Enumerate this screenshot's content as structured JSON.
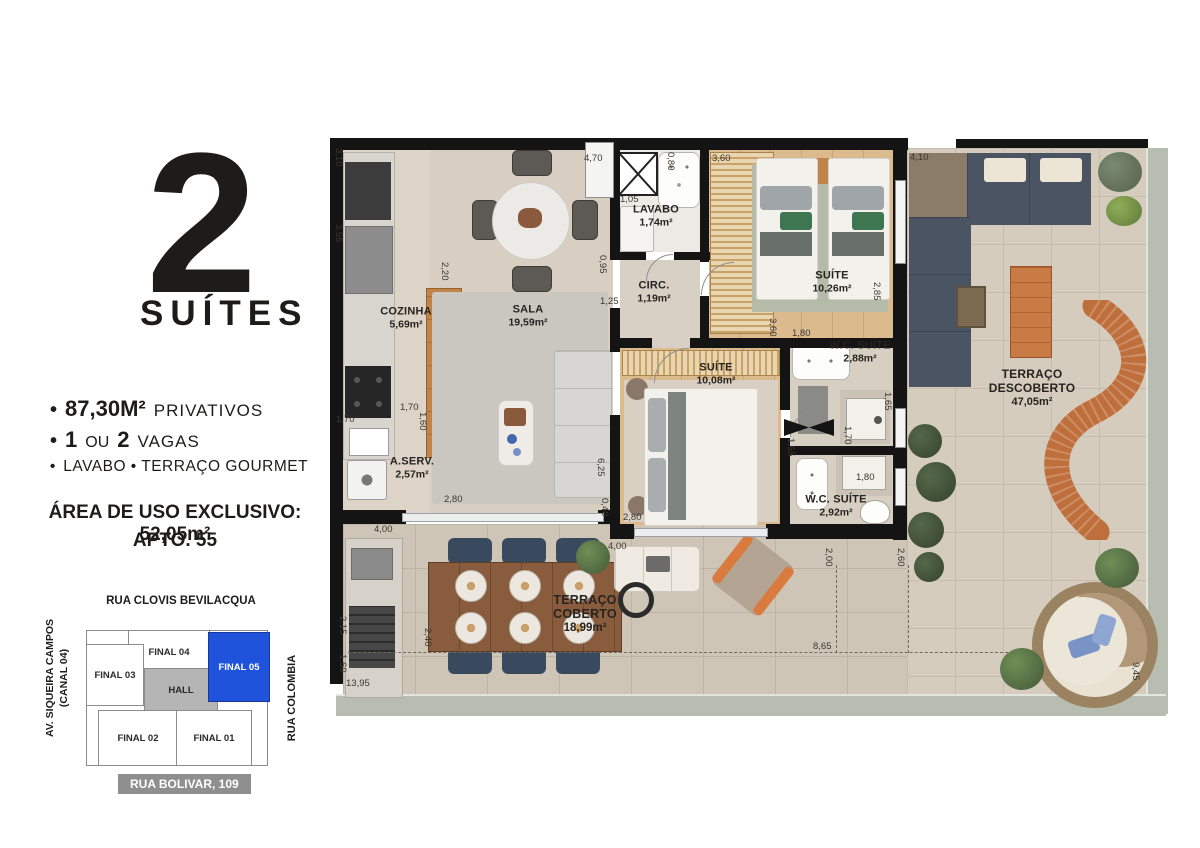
{
  "info_panel": {
    "headline": {
      "number": "2",
      "word": "SUÍTES"
    },
    "features": {
      "f1": {
        "b": "•",
        "strong": "87,30M²",
        "rest": "PRIVATIVOS"
      },
      "f2": {
        "b": "•",
        "s1": "1",
        "m": "OU",
        "s2": "2",
        "rest": "VAGAS"
      },
      "f3": {
        "b": "•",
        "rest": "LAVABO • TERRAÇO GOURMET"
      }
    },
    "exclusive": {
      "line1": "ÁREA DE USO EXCLUSIVO: 52,05m²",
      "line2": "APTO. 55"
    }
  },
  "keyplan": {
    "streets": {
      "top": "RUA CLOVIS BEVILACQUA",
      "left1": "AV. SIQUEIRA CAMPOS",
      "left2": "(CANAL 04)",
      "right": "RUA COLOMBIA",
      "bottom": "RUA BOLIVAR, 109"
    },
    "units": {
      "f04": "FINAL 04",
      "f03": "FINAL 03",
      "f05": "FINAL 05",
      "hall": "HALL",
      "f02": "FINAL 02",
      "f01": "FINAL 01"
    },
    "colors": {
      "highlight": "#1f53dc",
      "hall": "#b5b5b5",
      "badge": "#8f8f8f"
    }
  },
  "floorplan": {
    "rooms": {
      "cozinha": {
        "name": "COZINHA",
        "area": "5,69m²"
      },
      "sala": {
        "name": "SALA",
        "area": "19,59m²"
      },
      "lavabo": {
        "name": "LAVABO",
        "area": "1,74m²"
      },
      "circ": {
        "name": "CIRC.",
        "area": "1,19m²"
      },
      "suite1": {
        "name": "SUÍTE",
        "area": "10,26m²"
      },
      "suite2": {
        "name": "SUÍTE",
        "area": "10,08m²"
      },
      "wc1": {
        "name": "W.C. SUÍTE",
        "area": "2,88m²"
      },
      "wc2": {
        "name": "W.C. SUÍTE",
        "area": "2,92m²"
      },
      "aserv": {
        "name": "A.SERV.",
        "area": "2,57m²"
      },
      "tcoberto": {
        "name": "TERRAÇO COBERTO",
        "area": "18,99m²"
      },
      "tdescoberto": {
        "name": "TERRAÇO DESCOBERTO",
        "area": "47,05m²"
      }
    },
    "dims": {
      "d01": "3,10",
      "d02": "3,55",
      "d03": "4,70",
      "d04": "1,05",
      "d05": "0,80",
      "d06": "3,60",
      "d07": "4,10",
      "d08": "2,20",
      "d09": "0,95",
      "d10": "1,25",
      "d11": "2,85",
      "d12": "1,80",
      "d13": "1,65",
      "d14": "3,60",
      "d15": "1,70",
      "d16": "1,70",
      "d17": "1,60",
      "d18": "2,80",
      "d19": "4,00",
      "d20": "6,25",
      "d21": "0,40",
      "d22": "2,80",
      "d23": "1,55",
      "d24": "1,70",
      "d25": "1,80",
      "d26": "4,00",
      "d27": "2,00",
      "d28": "2,60",
      "d29": "2,15",
      "d30": "1,60",
      "d31": "2,40",
      "d32": "13,95",
      "d33": "8,65",
      "d34": "9,45"
    }
  }
}
